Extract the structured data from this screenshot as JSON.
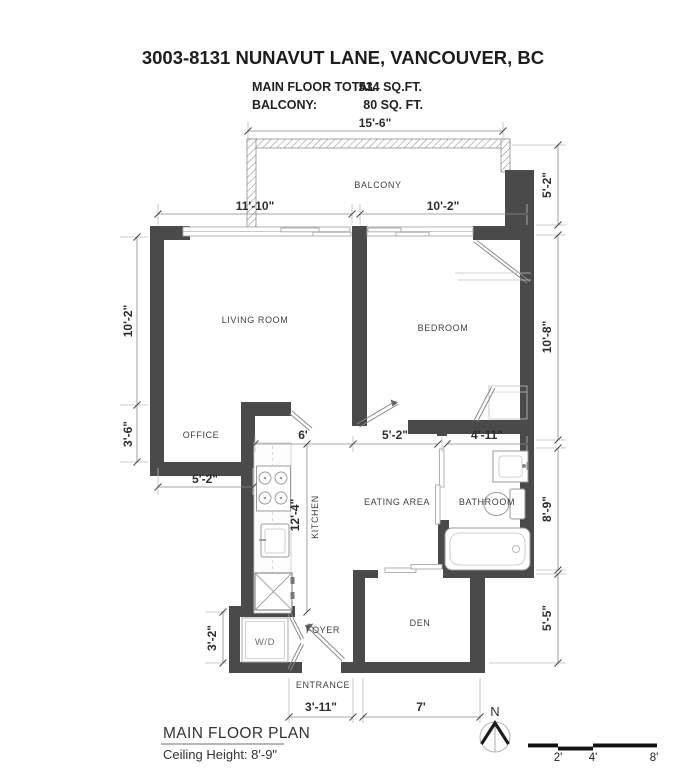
{
  "header": {
    "title": "3003-8131 NUNAVUT LANE, VANCOUVER, BC",
    "areas": [
      {
        "label": "MAIN FLOOR TOTAL:",
        "value": "534 SQ.FT."
      },
      {
        "label": "BALCONY:",
        "value": "80 SQ. FT."
      }
    ]
  },
  "rooms": {
    "balcony": "BALCONY",
    "living_room": "LIVING ROOM",
    "bedroom": "BEDROOM",
    "office": "OFFICE",
    "kitchen": "KITCHEN",
    "eating_area": "EATING AREA",
    "bathroom": "BATHROOM",
    "den": "DEN",
    "foyer": "FOYER",
    "entrance": "ENTRANCE",
    "washer_dryer": "W/D"
  },
  "dimensions": {
    "balcony_width": "15'-6\"",
    "living_width": "11'-10\"",
    "bedroom_width": "10'-2\"",
    "living_height": "10'-2\"",
    "office_height": "3'-6\"",
    "office_width": "5'-2\"",
    "kitchen_width": "6'",
    "eating_width": "5'-2\"",
    "bathroom_width": "4'-11\"",
    "kitchen_height": "12'-4\"",
    "wd_height": "3'-2\"",
    "right_top": "5'-2\"",
    "bedroom_height": "10'-8\"",
    "bathroom_height": "8'-9\"",
    "den_height": "5'-5\"",
    "entrance_width": "3'-11\"",
    "den_width": "7'"
  },
  "footer": {
    "plan_title": "MAIN FLOOR PLAN",
    "ceiling_height": "Ceiling Height: 8'-9\"",
    "compass_north": "N",
    "scale_ticks": [
      "2'",
      "4'",
      "8'"
    ]
  },
  "colors": {
    "wall": "#4a4a4a",
    "dim_text": "#2e2e2e",
    "room_text": "#3f3f3f",
    "light_line": "#bdbdbd",
    "hatch_line": "#8f8f8f"
  }
}
